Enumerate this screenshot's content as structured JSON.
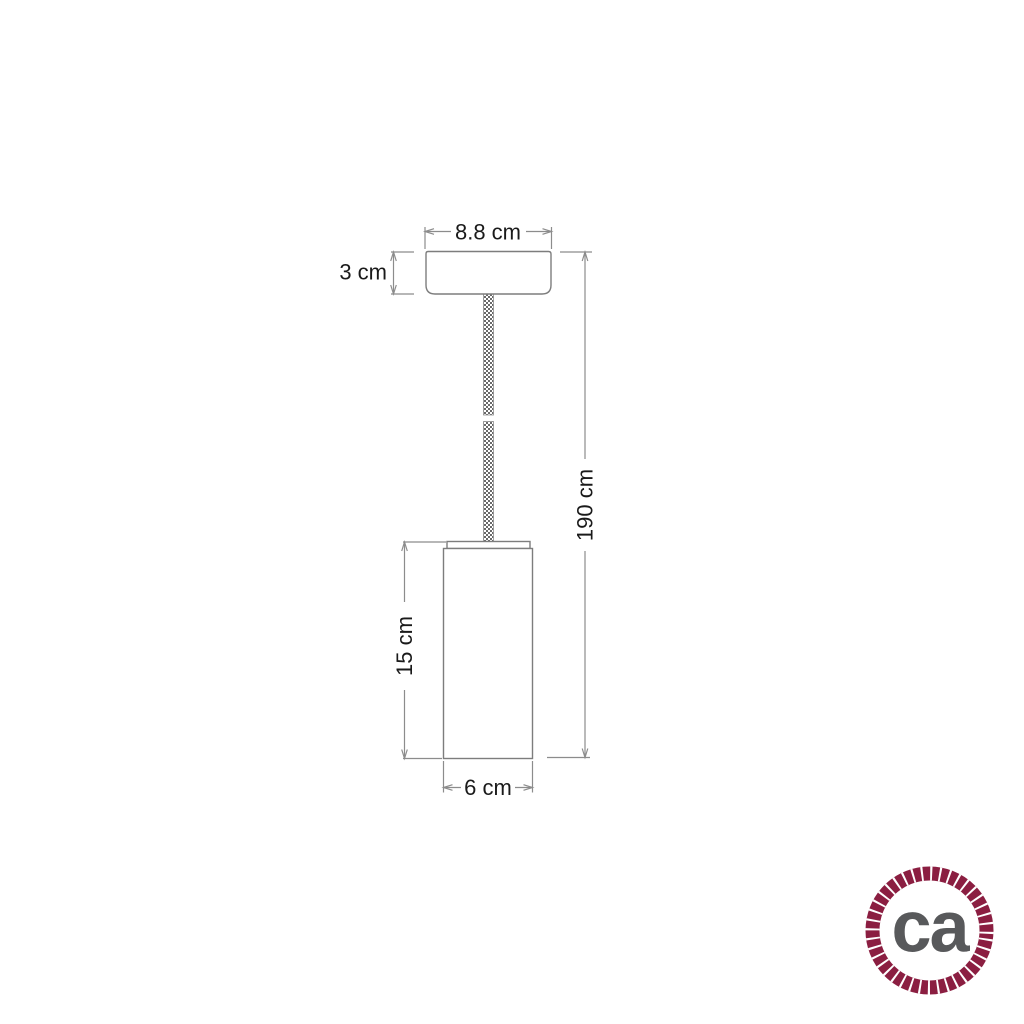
{
  "diagram": {
    "type": "pendant-lamp-dimension-drawing",
    "labels": {
      "rose_width": "8.8 cm",
      "rose_height": "3 cm",
      "overall_drop": "190 cm",
      "shade_height": "15 cm",
      "shade_diameter": "6 cm"
    }
  },
  "logo": {
    "text": "ca",
    "rope_color": "#8b1e41",
    "text_color": "#58595b"
  },
  "colors": {
    "dimension_line": "#8c8c8c",
    "object_outline": "#7d7d7d",
    "label_text": "#1a1a1a",
    "cable_pattern_dark": "#6a6a6a",
    "background": "#ffffff"
  }
}
